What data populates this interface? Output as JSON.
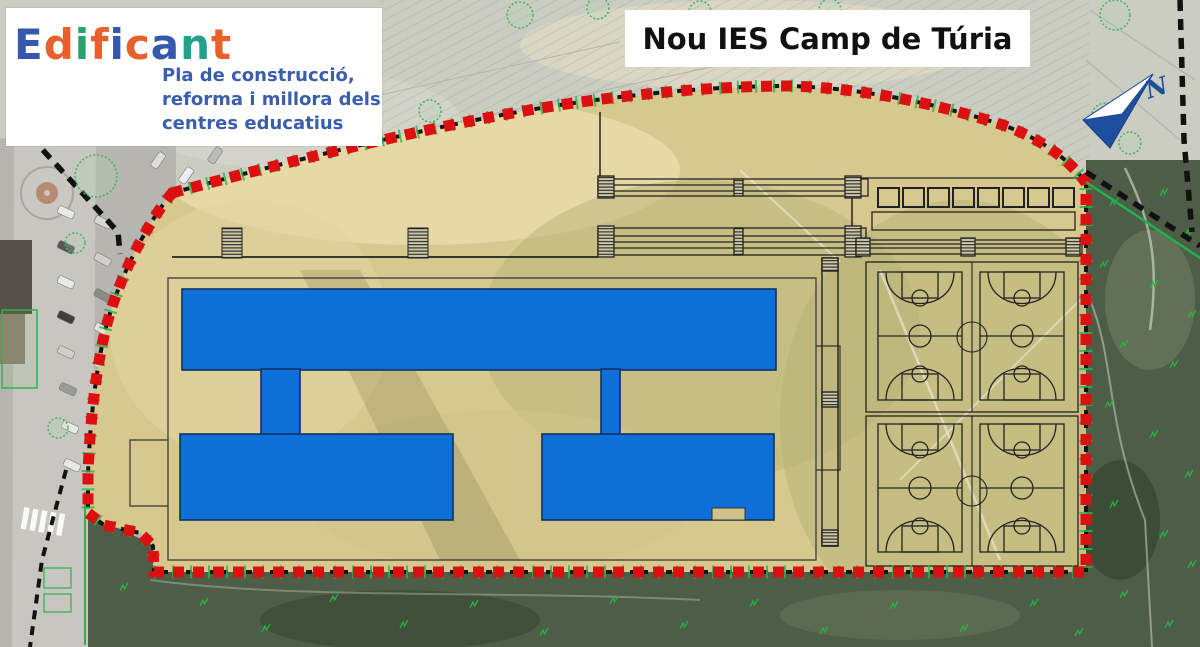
{
  "branding": {
    "logo_text": "Edificant",
    "logo_letters": [
      {
        "char": "E",
        "color": "#3558ac"
      },
      {
        "char": "d",
        "color": "#e8612c"
      },
      {
        "char": "i",
        "color": "#2aa36b"
      },
      {
        "char": "f",
        "color": "#e8612c"
      },
      {
        "char": "i",
        "color": "#3558ac"
      },
      {
        "char": "c",
        "color": "#e8612c"
      },
      {
        "char": "a",
        "color": "#3558ac"
      },
      {
        "char": "n",
        "color": "#23a189"
      },
      {
        "char": "t",
        "color": "#e8612c"
      }
    ],
    "subtitle_lines": [
      "Pla de construcció,",
      "reforma i millora dels",
      "centres educatius"
    ],
    "subtitle_color": "#3a5dae"
  },
  "title": {
    "text": "Nou IES Camp de Túria"
  },
  "north": {
    "label": "N"
  },
  "map_colors": {
    "boundary_red": "#dc1010",
    "boundary_black": "#151515",
    "building_blue": "#0e6fd8",
    "building_outline": "#10315f",
    "site_fill": "#d7c88f",
    "vegetation_dark": "#4e5d48",
    "scrub_green": "#25b544",
    "tree_green": "#43b163",
    "road_grey": "#b6b5af",
    "topo_grey": "#cbccc2",
    "north_arrow_blue": "#1d4f9e"
  }
}
